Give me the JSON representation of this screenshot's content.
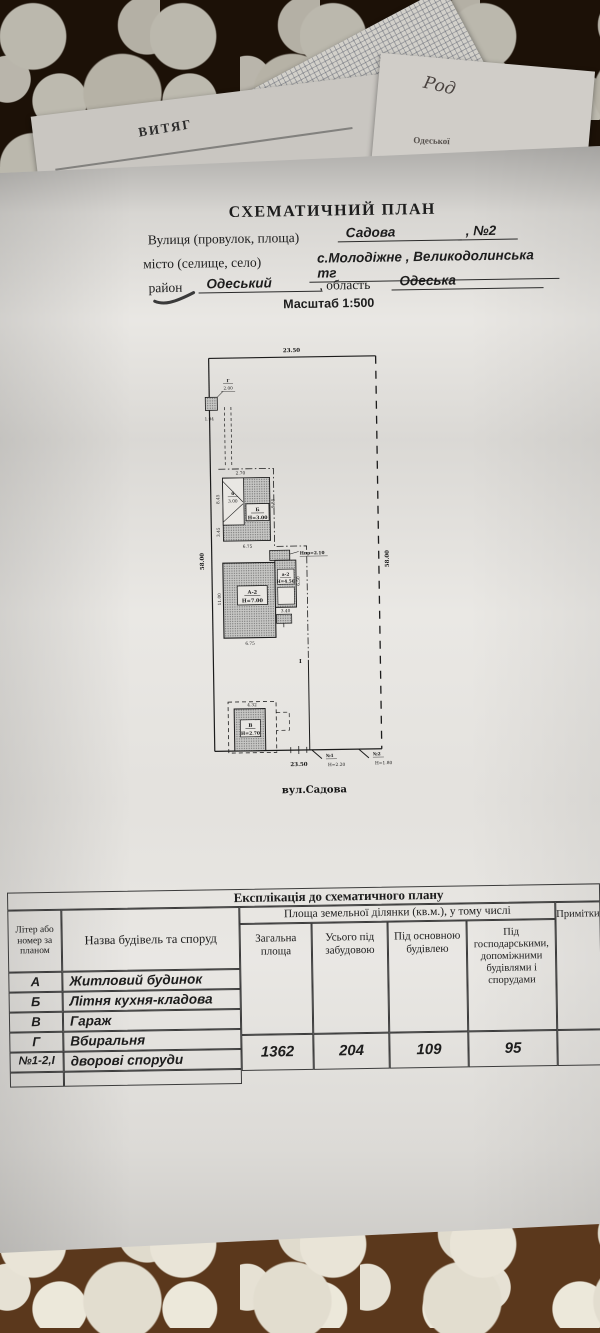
{
  "background": {
    "vytiag": "ВИТЯГ",
    "handwritten": "Род",
    "fragment": "Одеської"
  },
  "header": {
    "title": "СХЕМАТИЧНИЙ ПЛАН",
    "street_label": "Вулиця (провулок, площа)",
    "street_value": "Садова",
    "street_number": ", №2",
    "city_label": "місто (селище, село)",
    "city_value": "с.Молодіжне , Великодолинська тг",
    "district_label": "район",
    "district_value": "Одеський",
    "region_label": ", область",
    "region_value": "Одеська",
    "scale": "Масштаб 1:500"
  },
  "plan": {
    "street_name": "вул.Садова",
    "dims": {
      "top_width": "23.50",
      "bottom_width": "23.50",
      "left_height": "58.00",
      "right_height": "58.00",
      "g_width": "2.00",
      "g_offset": "1.04",
      "b_top": "2.70",
      "b_left_upper": "8.45",
      "b_left_lower": "3.45",
      "b_right": "9.85",
      "b_bottom": "6.75",
      "a_left": "11.00",
      "a_bottom": "6.75",
      "a_annex_right": "6.50",
      "a_annex_bottom": "3.40",
      "v_top": "4.32"
    },
    "labels": {
      "building_g": "Г",
      "building_b": "Б",
      "building_b_h": "Н=3.00",
      "annex_b": "б",
      "annex_b_h": "3.00",
      "building_a": "А-2",
      "building_a_h": "Н=7.00",
      "annex_a": "а-2",
      "annex_a_h": "Н=4.50",
      "porch_h": "Нпр=2.10",
      "building_v": "В",
      "building_v_h": "Н=2.70",
      "yard": "І",
      "gate1": "№1",
      "gate1_h": "Н=2.20",
      "gate2": "№2",
      "gate2_h": "Н=1.80"
    }
  },
  "table": {
    "title": "Експлікація до схематичного плану",
    "col_liter": "Літер або номер за планом",
    "col_name": "Назва будівель та споруд",
    "col_area_span": "Площа земельної ділянки (кв.м.), у тому числі",
    "col_total": "Загальна площа",
    "col_built": "Усього під забудовою",
    "col_main": "Під основною будівлею",
    "col_aux": "Під господарськими, допоміжними будівлями і спорудами",
    "col_notes": "Примітки",
    "rows": [
      {
        "liter": "А",
        "name": "Житловий будинок"
      },
      {
        "liter": "Б",
        "name": "Літня кухня-кладова"
      },
      {
        "liter": "В",
        "name": "Гараж"
      },
      {
        "liter": "Г",
        "name": "Вбиральня"
      },
      {
        "liter": "№1-2,І",
        "name": "дворові споруди"
      }
    ],
    "totals": {
      "total": "1362",
      "built": "204",
      "main": "109",
      "aux": "95"
    }
  }
}
